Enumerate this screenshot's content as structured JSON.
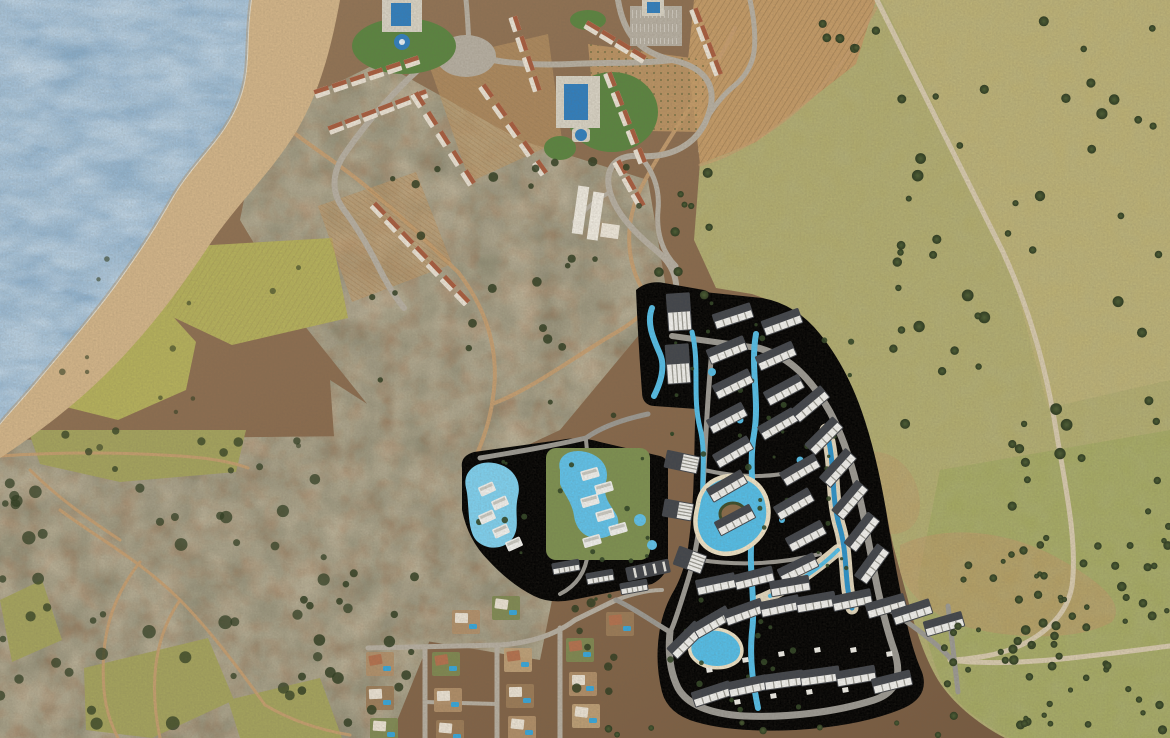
{
  "meta": {
    "title": "Aerial satellite view of coastal resort masterplan",
    "description": "Top-down satellite photograph of a Mediterranean coastline with an existing resort village, farm fields, scrubland, and a rendered new resort development with winding lagoon pools and rows of apartment blocks.",
    "width": 1170,
    "height": 738
  },
  "palette": {
    "sea": "#7fa7c9",
    "seaLight": "#b7d1e3",
    "seaDark": "#5f88ac",
    "foam": "#f2ead6",
    "beach": "#d4b68a",
    "rocky": "#b2a189",
    "scrub": "#8d7355",
    "scrubDark": "#4c4a36",
    "scrubLight": "#d0b28a",
    "dirt": "#c89f70",
    "countryRoad": "#d8cbaf",
    "fieldYellow": "#b6b25c",
    "fieldOlive": "#a5a45e",
    "fieldEast": "#b3ae6f",
    "fieldEastLight": "#bfb478",
    "fieldEastGreen": "#a4ab62",
    "plowed": "#c59c68",
    "lawn": "#5a8540",
    "deck": "#d9d4c6",
    "poolBlue": "#2f7fc0",
    "lagoon": "#53bfea",
    "lagoonDeep": "#1e82bd",
    "lagoonPale": "#7ed2f2",
    "sandBeach": "#efe4c8",
    "road": "#9c9a94",
    "roadLight": "#b7b0a3",
    "building": "#f3f3f0",
    "roofDark": "#40444b",
    "roofTerracotta": "#a85c3e",
    "houseWhite": "#ece4d6",
    "houseTerracotta": "#b4714e",
    "island": "#8a6b4a",
    "tree": "#3b4c2a",
    "treeDark": "#2e3c20",
    "palm": "#2f4423",
    "lotTan": "#b2906a",
    "lotBrown": "#9c7c58",
    "lotGreen": "#7e8a52"
  },
  "scene": {
    "regions": [
      {
        "id": "sea",
        "label": "sea water, top-left"
      },
      {
        "id": "shoreline-beach",
        "label": "sandy and rocky beach strip along the coast"
      },
      {
        "id": "existing-resort",
        "label": "existing resort village with pools, terracotta-roof buildings, parking and vineyards (top-center)"
      },
      {
        "id": "farm-fields-west",
        "label": "yellow-green cultivated fields near the shore (left-center)"
      },
      {
        "id": "olive-field-east",
        "label": "pale olive pasture with scattered trees (right half)"
      },
      {
        "id": "scrubland",
        "label": "brown Mediterranean scrub with dirt trails (center and bottom-left)"
      },
      {
        "id": "masterplan-development",
        "label": "rendered new resort: apartment rows, lagoon pools with sand beaches, gray roads (center-right)"
      },
      {
        "id": "villa-clusters-west",
        "label": "rendered villa clusters with free-form pools (center-left of development)"
      },
      {
        "id": "villa-village-south",
        "label": "existing small villa village with private pools (bottom-center)"
      },
      {
        "id": "country-road-northeast",
        "label": "diagonal country road, top-right"
      },
      {
        "id": "country-road-southeast",
        "label": "country road crossing, bottom-right"
      }
    ],
    "existing_resort": {
      "swimming_pools": 4,
      "building_rows": 10,
      "fountain": 1
    },
    "development": {
      "apartment_blocks": 48,
      "lagoon_channels": 4,
      "lagoon_ponds": 3,
      "villa_clusters": 3,
      "central_island": 1
    },
    "village": {
      "villa_lots": 15
    }
  }
}
